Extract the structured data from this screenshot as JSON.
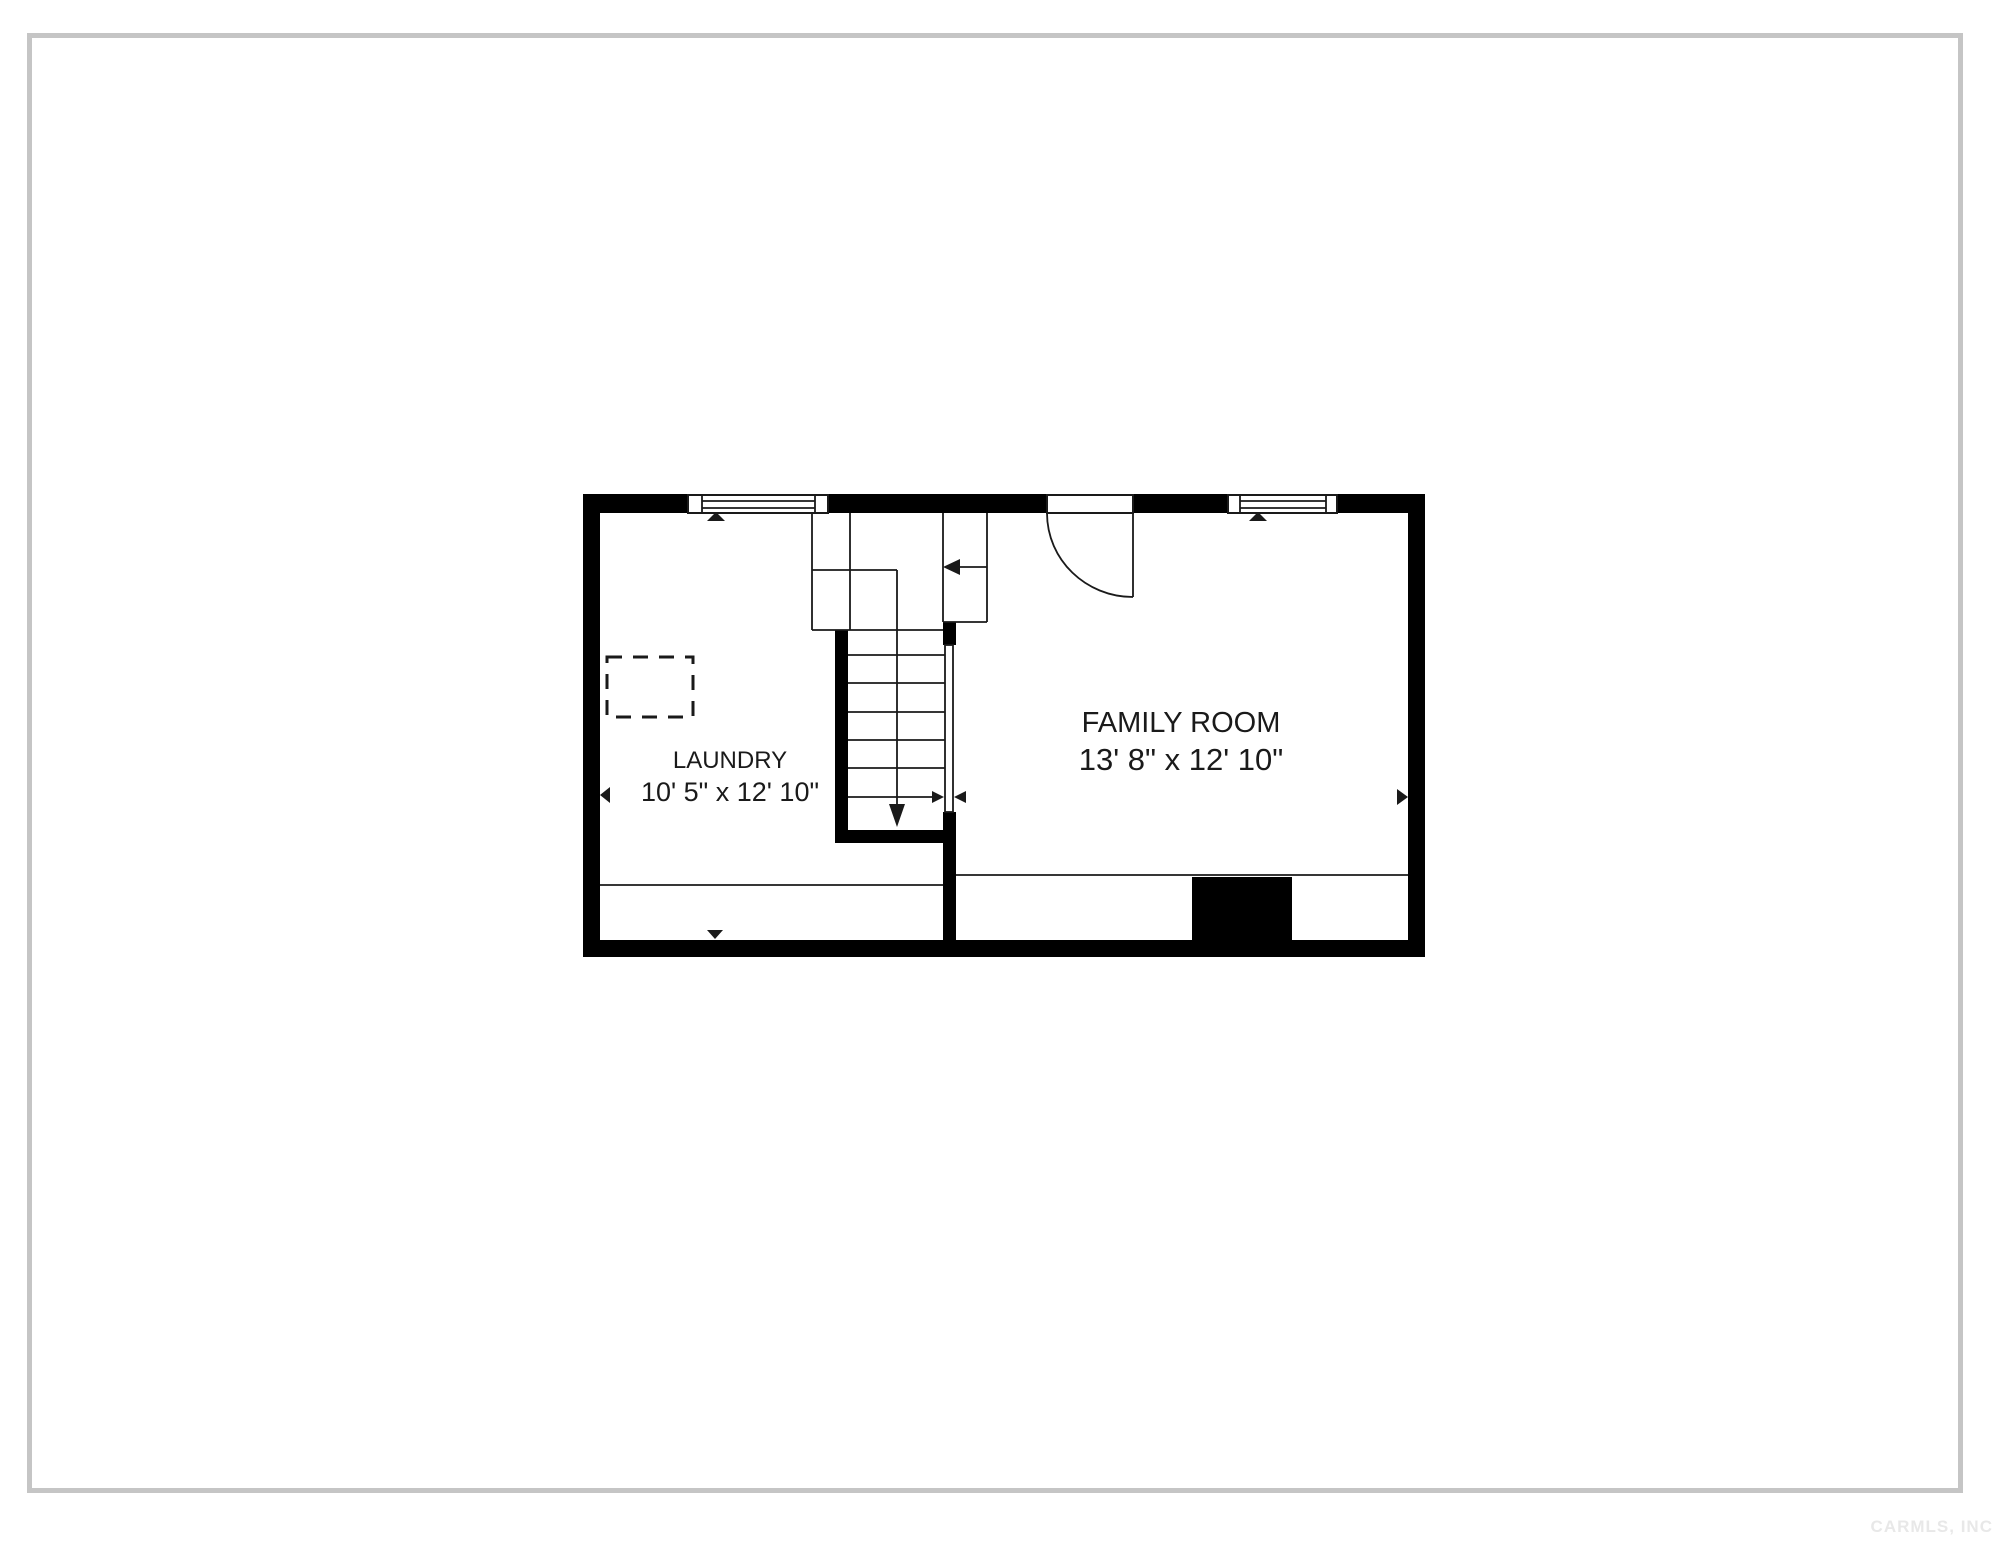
{
  "rooms": [
    {
      "name": "LAUNDRY",
      "dims": "10' 5\" x 12' 10\""
    },
    {
      "name": "FAMILY ROOM",
      "dims": "13' 8\" x 12' 10\""
    }
  ],
  "watermark": "CARMLS, INC",
  "colors": {
    "wall": "#000000",
    "line": "#1a1a1a",
    "text": "#1a1a1a",
    "page-border": "#c5c5c5",
    "watermark-color": "#e8e8e8",
    "background": "#ffffff"
  }
}
